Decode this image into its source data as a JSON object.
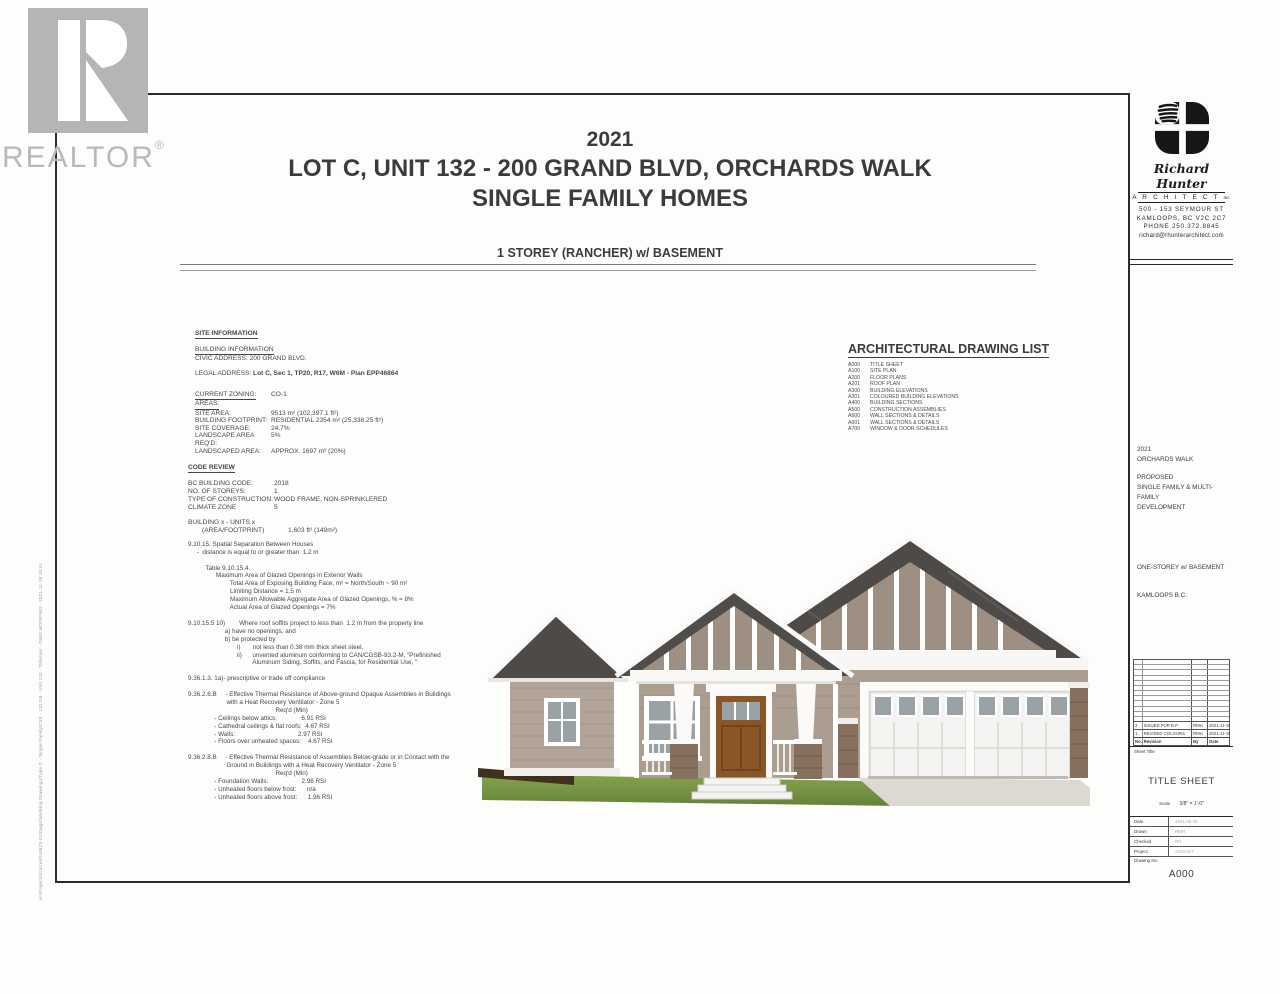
{
  "watermark": {
    "name": "REALTOR",
    "reg": "®"
  },
  "sheet": {
    "title_year": "2021",
    "title_line1": "LOT C, UNIT 132 - 200 GRAND BLVD, ORCHARDS WALK",
    "title_line2": "SINGLE FAMILY HOMES",
    "subtitle": "1 STOREY (RANCHER) w/ BASEMENT"
  },
  "site_information": {
    "heading": "SITE INFORMATION",
    "building_heading": "BUILDING INFORMATION",
    "civic": "CIVIC ADDRESS: 200 GRAND BLVD.",
    "legal_label": "LEGAL ADDRESS:",
    "legal_value": "Lot C, Sec 1, TP20, R17, W6M - Plan EPP46864",
    "zoning_label": "CURRENT ZONING:",
    "zoning_value": "CO-1",
    "areas_heading": "AREAS:",
    "rows": [
      {
        "label": "SITE AREA:",
        "value": "9513 m² (102,397.1 ft²)"
      },
      {
        "label": "BUILDING FOOTPRINT:",
        "value": "RESIDENTIAL 2354 m² (25,338.25 ft²)"
      },
      {
        "label": "SITE COVERAGE:",
        "value": "24.7%"
      },
      {
        "label": "LANDSCAPE AREA REQ'D:",
        "value": "5%"
      },
      {
        "label": "LANDSCAPED AREA:",
        "value": "APPROX.  1697 m² (20%)"
      }
    ]
  },
  "code_review": {
    "heading": "CODE REVIEW",
    "rows": [
      {
        "label": "BC BUILDING CODE:",
        "value": "2018"
      },
      {
        "label": "NO. OF STOREYS:",
        "value": "1"
      },
      {
        "label": "TYPE OF CONSTRUCTION:",
        "value": "WOOD FRAME, NON-SPRINKLERED"
      },
      {
        "label": "CLIMATE ZONE",
        "value": "5"
      }
    ],
    "building_units_line": "BUILDING x - UNITS x",
    "building_units_label": "(AREA/FOOTPRINT)",
    "building_units_value": "1,603 ft² (149m²)",
    "lines": [
      "9.10.15. Spatial Separation Between Houses",
      "     -  distance is equal to or greater than  1.2 m",
      "",
      "          Table 9.10.15.4.",
      "                Maximum Area of Glazed Openings in Exterior Walls",
      "                        Total Area of Exposing Building Face, m² = North/South ~ 90 m²",
      "                        Limiting Distance = 1.5 m",
      "                        Maximum Allowable Aggregate Area of Glazed Openings, % = 8%",
      "                        Actual Area of Glazed Openings = 7%",
      "",
      "9.10.15.5 10)        Where roof soffits project to less than  1.2 m from the property line",
      "                     a) have no openings, and",
      "                     b) be protected by",
      "                            i)       not less than 0.38 mm thick sheet steel,",
      "                            ii)      unvented aluminum conforming to CAN/CGSB-93.2-M, \"Prefinished",
      "                                     Aluminum Siding, Soffits, and Fascia, for Residential Use, \"",
      "",
      "9.36.1.3. 1a)- prescriptive or trade off compliance",
      "",
      "9.36.2.6.B     - Effective Thermal Resistance of Above-ground Opaque Assemblies in Buildings",
      "                      with a Heat Recovery Ventilator - Zone 5",
      "                                                  Req'd (Min)",
      "               - Ceilings below attics:              6.91 RSI",
      "               - Cathedral ceilings & flat roofs:  4.67 RSI",
      "               - Walls:                                    2.97 RSI",
      "               - Floors over unheated spaces:    4.67 RSI",
      "",
      "9.36.2.8.B     - Effective Thermal Resistance of Assemblies Below-grade or in Contact with the",
      "                      Ground in Buildings with a Heat Recovery Ventilator - Zone 5",
      "                                                  Req'd (Min)",
      "               - Foundation Walls:                   2.98 RSI",
      "               - Unheated floors below frost:      n/a",
      "               - Unheated floors above frost:      1.96 RSI"
    ]
  },
  "drawing_list": {
    "heading": "ARCHITECTURAL DRAWING LIST",
    "items": [
      {
        "code": "A000",
        "name": "TITLE SHEET"
      },
      {
        "code": "A100",
        "name": "SITE PLAN"
      },
      {
        "code": "A200",
        "name": "FLOOR PLANS"
      },
      {
        "code": "A201",
        "name": "ROOF PLAN"
      },
      {
        "code": "A300",
        "name": "BUILDING ELEVATIONS"
      },
      {
        "code": "A301",
        "name": "COLOURED BUILDING ELEVATIONS"
      },
      {
        "code": "A400",
        "name": "BUILDING SECTIONS"
      },
      {
        "code": "A500",
        "name": "CONSTRUCTION ASSEMBLIES"
      },
      {
        "code": "A600",
        "name": "WALL SECTIONS & DETAILS"
      },
      {
        "code": "A601",
        "name": "WALL SECTIONS & DETAILS"
      },
      {
        "code": "A700",
        "name": "WINDOW & DOOR SCHEDULES"
      }
    ]
  },
  "architect": {
    "name_script": "Richard Hunter",
    "name_caps": "A R C H I T E C T",
    "inc": "Inc.",
    "address1": "500 - 153 SEYMOUR ST",
    "address2": "KAMLOOPS, BC V2C 2C7",
    "phone": "PHONE 250.372.8845",
    "email": "richard@rhunterarchitect.com"
  },
  "project": {
    "year": "2021",
    "name": "ORCHARDS WALK",
    "line1": "PROPOSED",
    "line2": "SINGLE FAMILY & MULTI-FAMILY",
    "line3": "DEVELOPMENT",
    "line4": "ONE-STOREY w/ BASEMENT",
    "line5": "KAMLOOPS B.C."
  },
  "revision_table": {
    "empty_row_count": 12,
    "rows": [
      {
        "no": "2",
        "revision": "ISSUED FOR B.P.",
        "by": "RMH",
        "date": "2021-11-18"
      },
      {
        "no": "1",
        "revision": "REVISED COLOURS",
        "by": "RMH",
        "date": "2021-11-18"
      }
    ],
    "header": {
      "no": "No.",
      "revision": "Revision",
      "by": "By",
      "date": "Date"
    }
  },
  "title_block": {
    "sheet_title_label": "Sheet Title",
    "sheet_title": "TITLE SHEET",
    "scale_label": "Scale",
    "scale_value": "3/8\" = 1'-0\"",
    "fields": [
      {
        "label": "Date",
        "value": "2021-02-26"
      },
      {
        "label": "Drawn",
        "value": "RMH"
      },
      {
        "label": "Checked",
        "value": "RH"
      },
      {
        "label": "Project",
        "value": "2104-017"
      }
    ],
    "drawing_no_label": "Drawing No.",
    "drawing_no": "A000"
  },
  "plot_stamp": "H:\\Projects\\Current\\10623-01\\Dwgs\\Working Drawings\\Type C - Single Family\\C33 - 132 O3 - Unit 132 - Titleman - DWG MODIFIED - 2021-11-18 10:41",
  "colors": {
    "roof": "#4e4a47",
    "siding": "#ab9d90",
    "gable_siding": "#9d8f82",
    "stone": "#87705d",
    "door": "#8a5527",
    "lawn": "#7d9a45",
    "watermark_gray": "#b5b5b5"
  }
}
